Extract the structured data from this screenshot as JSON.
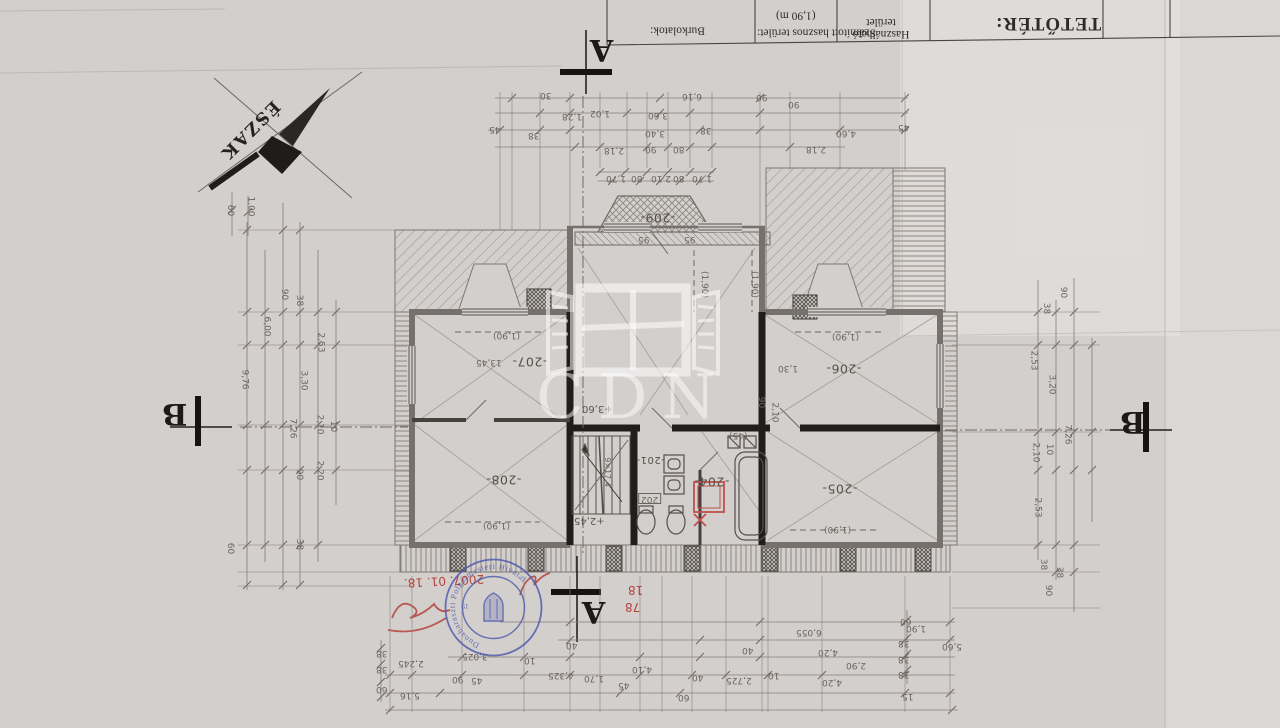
{
  "title_block": {
    "title": "TETŐTÉR:",
    "cell_used": "Használható terület",
    "cell_calc": "Számított hasznos terület:",
    "cell_calc2": "(1,90 m)",
    "cell_floor": "Burkolatok:"
  },
  "compass": {
    "north_label": "ÉSZAK"
  },
  "watermark": {
    "text": "CDN"
  },
  "section_markers": {
    "a": "A",
    "b": "B"
  },
  "stamp": {
    "ring_text": "Dunaharaszti Polgármesteri Hivatal",
    "number": "19",
    "date_handwritten": "2007. 01. 18.",
    "red_note_1": "18",
    "red_note_2": "78"
  },
  "rooms": [
    "-209-",
    "-207-",
    "-208-",
    "-206-",
    "-205-",
    "-204-",
    "-201-",
    "202"
  ],
  "levels": {
    "stair": "+2,45",
    "hall": "+3,60",
    "stair_formula": "9×17,4"
  },
  "dims": {
    "top": [
      "45",
      "38",
      "30",
      "1,28",
      "1,02",
      "3,60",
      "6,16",
      "90",
      "3,40",
      "2,18",
      "90",
      "80",
      "38",
      "90",
      "2,18",
      "4,60",
      "45"
    ],
    "left": [
      "60",
      "1,00",
      "9,76",
      "6,00",
      "90",
      "38",
      "2,53",
      "3,30",
      "7,26",
      "2,10",
      "10",
      "2,20",
      "90",
      "60",
      "38"
    ],
    "right": [
      "90",
      "38",
      "2,53",
      "3,20",
      "2,10",
      "10",
      "7,26",
      "2,53",
      "38",
      "38",
      "90"
    ],
    "bottom": [
      "5,16",
      "2,245",
      "3,025",
      "90",
      "45",
      "10",
      "40",
      "4,325",
      "1,70",
      "45",
      "4,10",
      "60",
      "40",
      "2,725",
      "10",
      "40",
      "6,055",
      "4,20",
      "4,20",
      "2,90",
      "1,90",
      "5,60",
      "15",
      "60",
      "38",
      "38",
      "38",
      "38",
      "38",
      "60"
    ],
    "inner": [
      "1,70",
      "80",
      "2,10",
      "80",
      "1,70",
      "95",
      "95",
      "90",
      "2,10",
      "(45)",
      "1,30",
      "(1,90)",
      "(1,90)",
      "(1,90)",
      "(1,90)",
      "(1,90)",
      "(1,90)",
      "13,45"
    ]
  }
}
